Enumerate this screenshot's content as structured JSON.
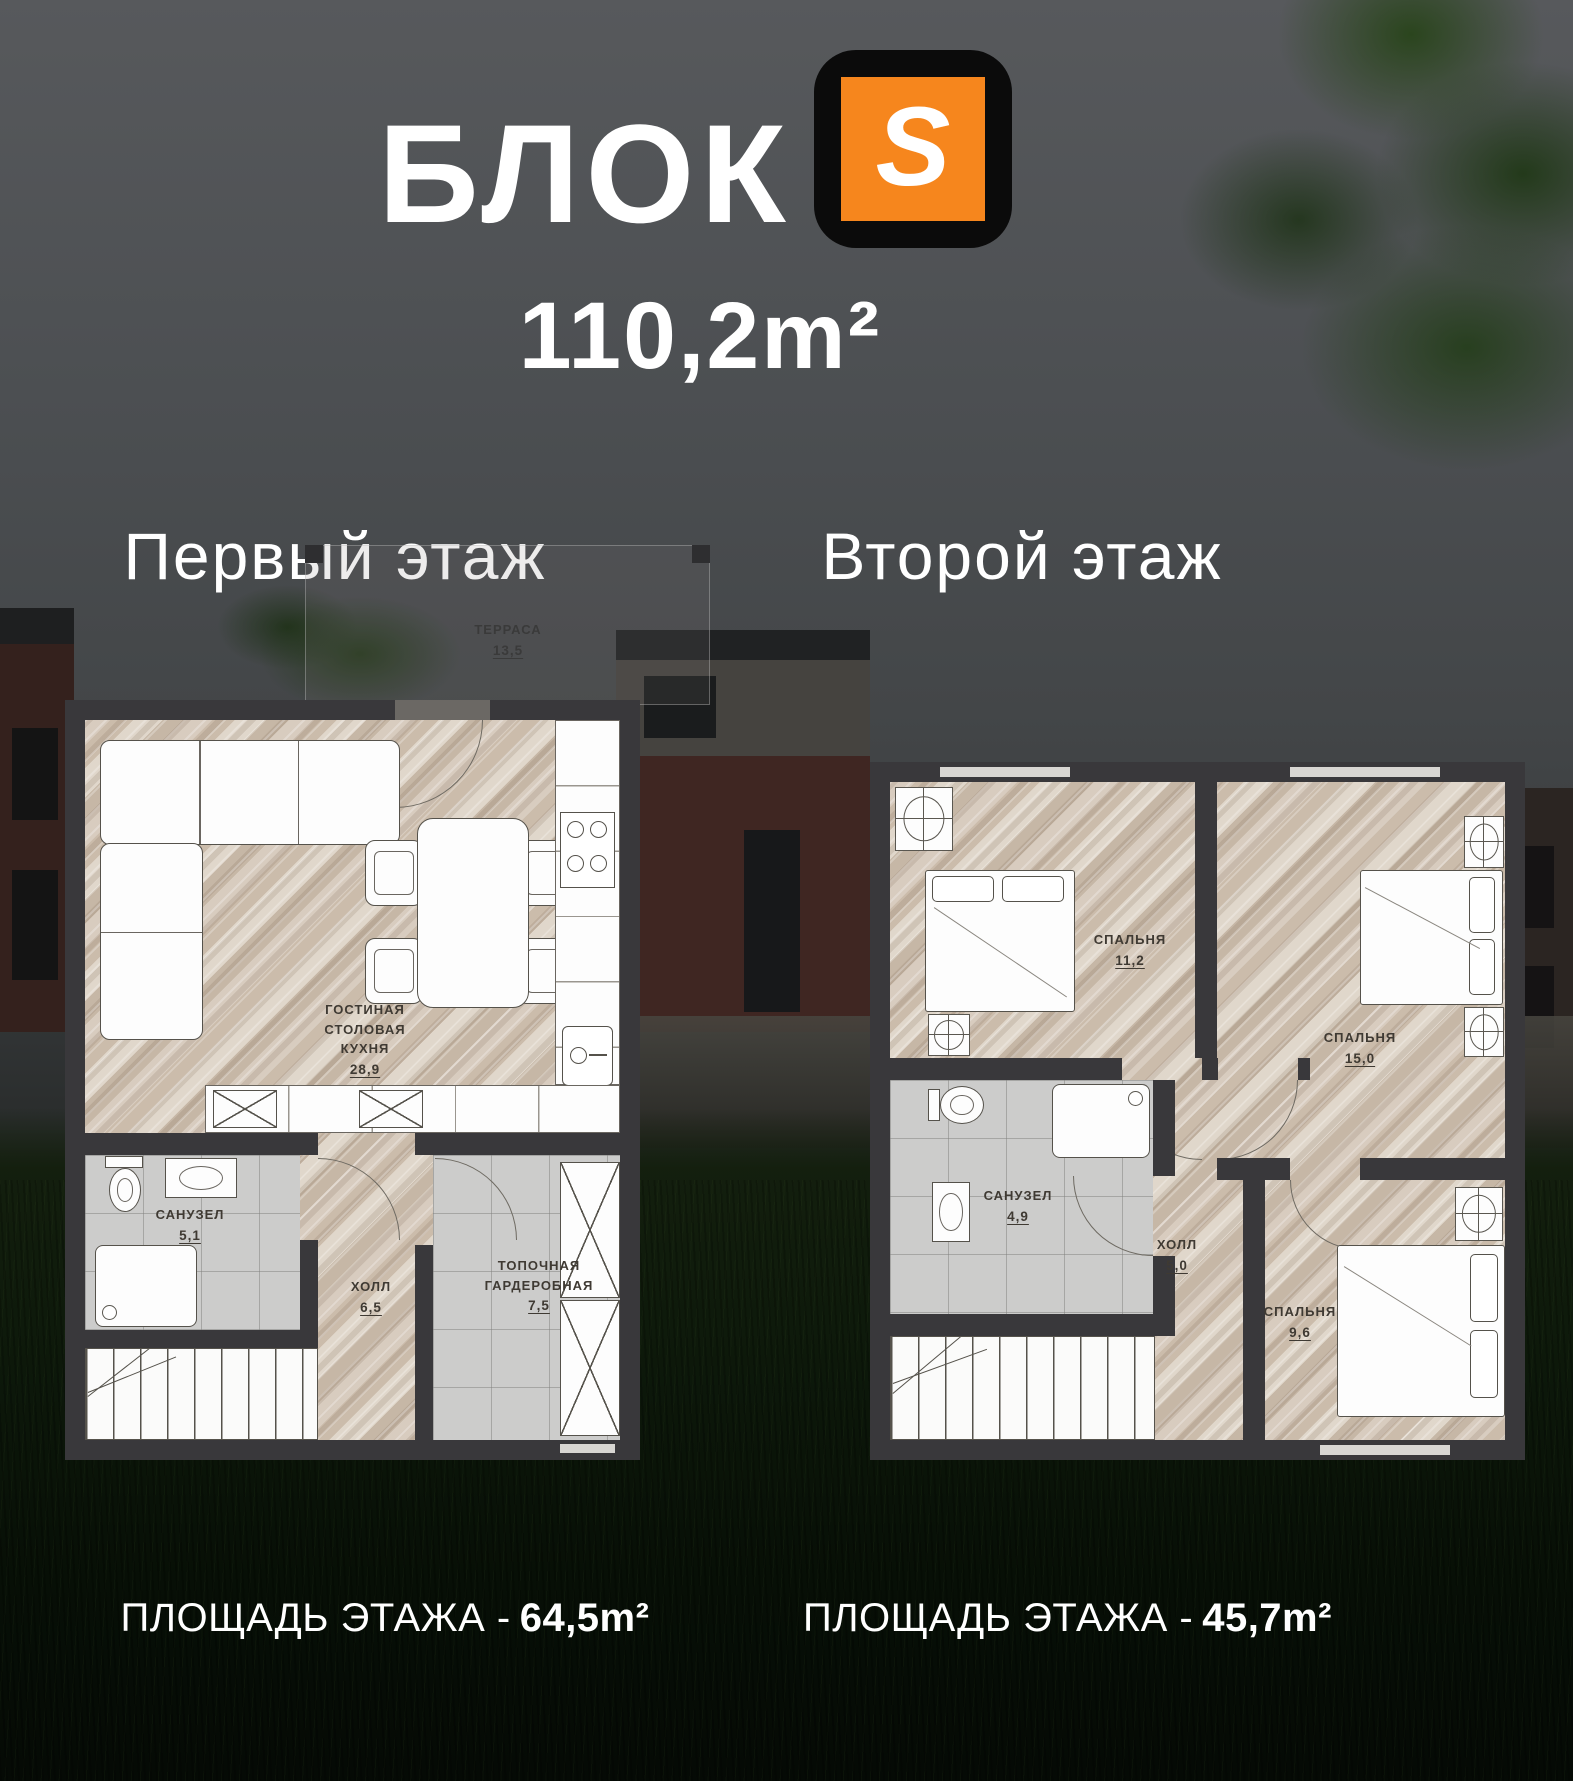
{
  "header": {
    "title": "БЛОК",
    "logo_letter": "S",
    "total_area": "110,2m²"
  },
  "colors": {
    "accent_orange": "#F6861D",
    "wall_dark": "#39383B",
    "wood_light": "#D3C7BA",
    "tile_gray": "#CCCCCB",
    "text_light": "#FFFFFF",
    "label_dark": "#3F3A33"
  },
  "floor1": {
    "heading": "Первый этаж",
    "terrace": {
      "name": "ТЕРРАСА",
      "area": "13,5"
    },
    "rooms": {
      "living": {
        "name": "ГОСТИНАЯ СТОЛОВАЯ КУХНЯ",
        "area": "28,9"
      },
      "bathroom": {
        "name": "САНУЗЕЛ",
        "area": "5,1"
      },
      "hall": {
        "name": "ХОЛЛ",
        "area": "6,5"
      },
      "boiler": {
        "name": "ТОПОЧНАЯ ГАРДЕРОБНАЯ",
        "area": "7,5"
      }
    },
    "footer": {
      "label": "ПЛОЩАДЬ ЭТАЖА -",
      "area": "64,5m²"
    }
  },
  "floor2": {
    "heading": "Второй этаж",
    "rooms": {
      "bedroom1": {
        "name": "СПАЛЬНЯ",
        "area": "11,2"
      },
      "bedroom2": {
        "name": "СПАЛЬНЯ",
        "area": "15,0"
      },
      "bathroom": {
        "name": "САНУЗЕЛ",
        "area": "4,9"
      },
      "hall": {
        "name": "ХОЛЛ",
        "area": "5,0"
      },
      "bedroom3": {
        "name": "СПАЛЬНЯ",
        "area": "9,6"
      }
    },
    "footer": {
      "label": "ПЛОЩАДЬ ЭТАЖА -",
      "area": "45,7m²"
    }
  }
}
